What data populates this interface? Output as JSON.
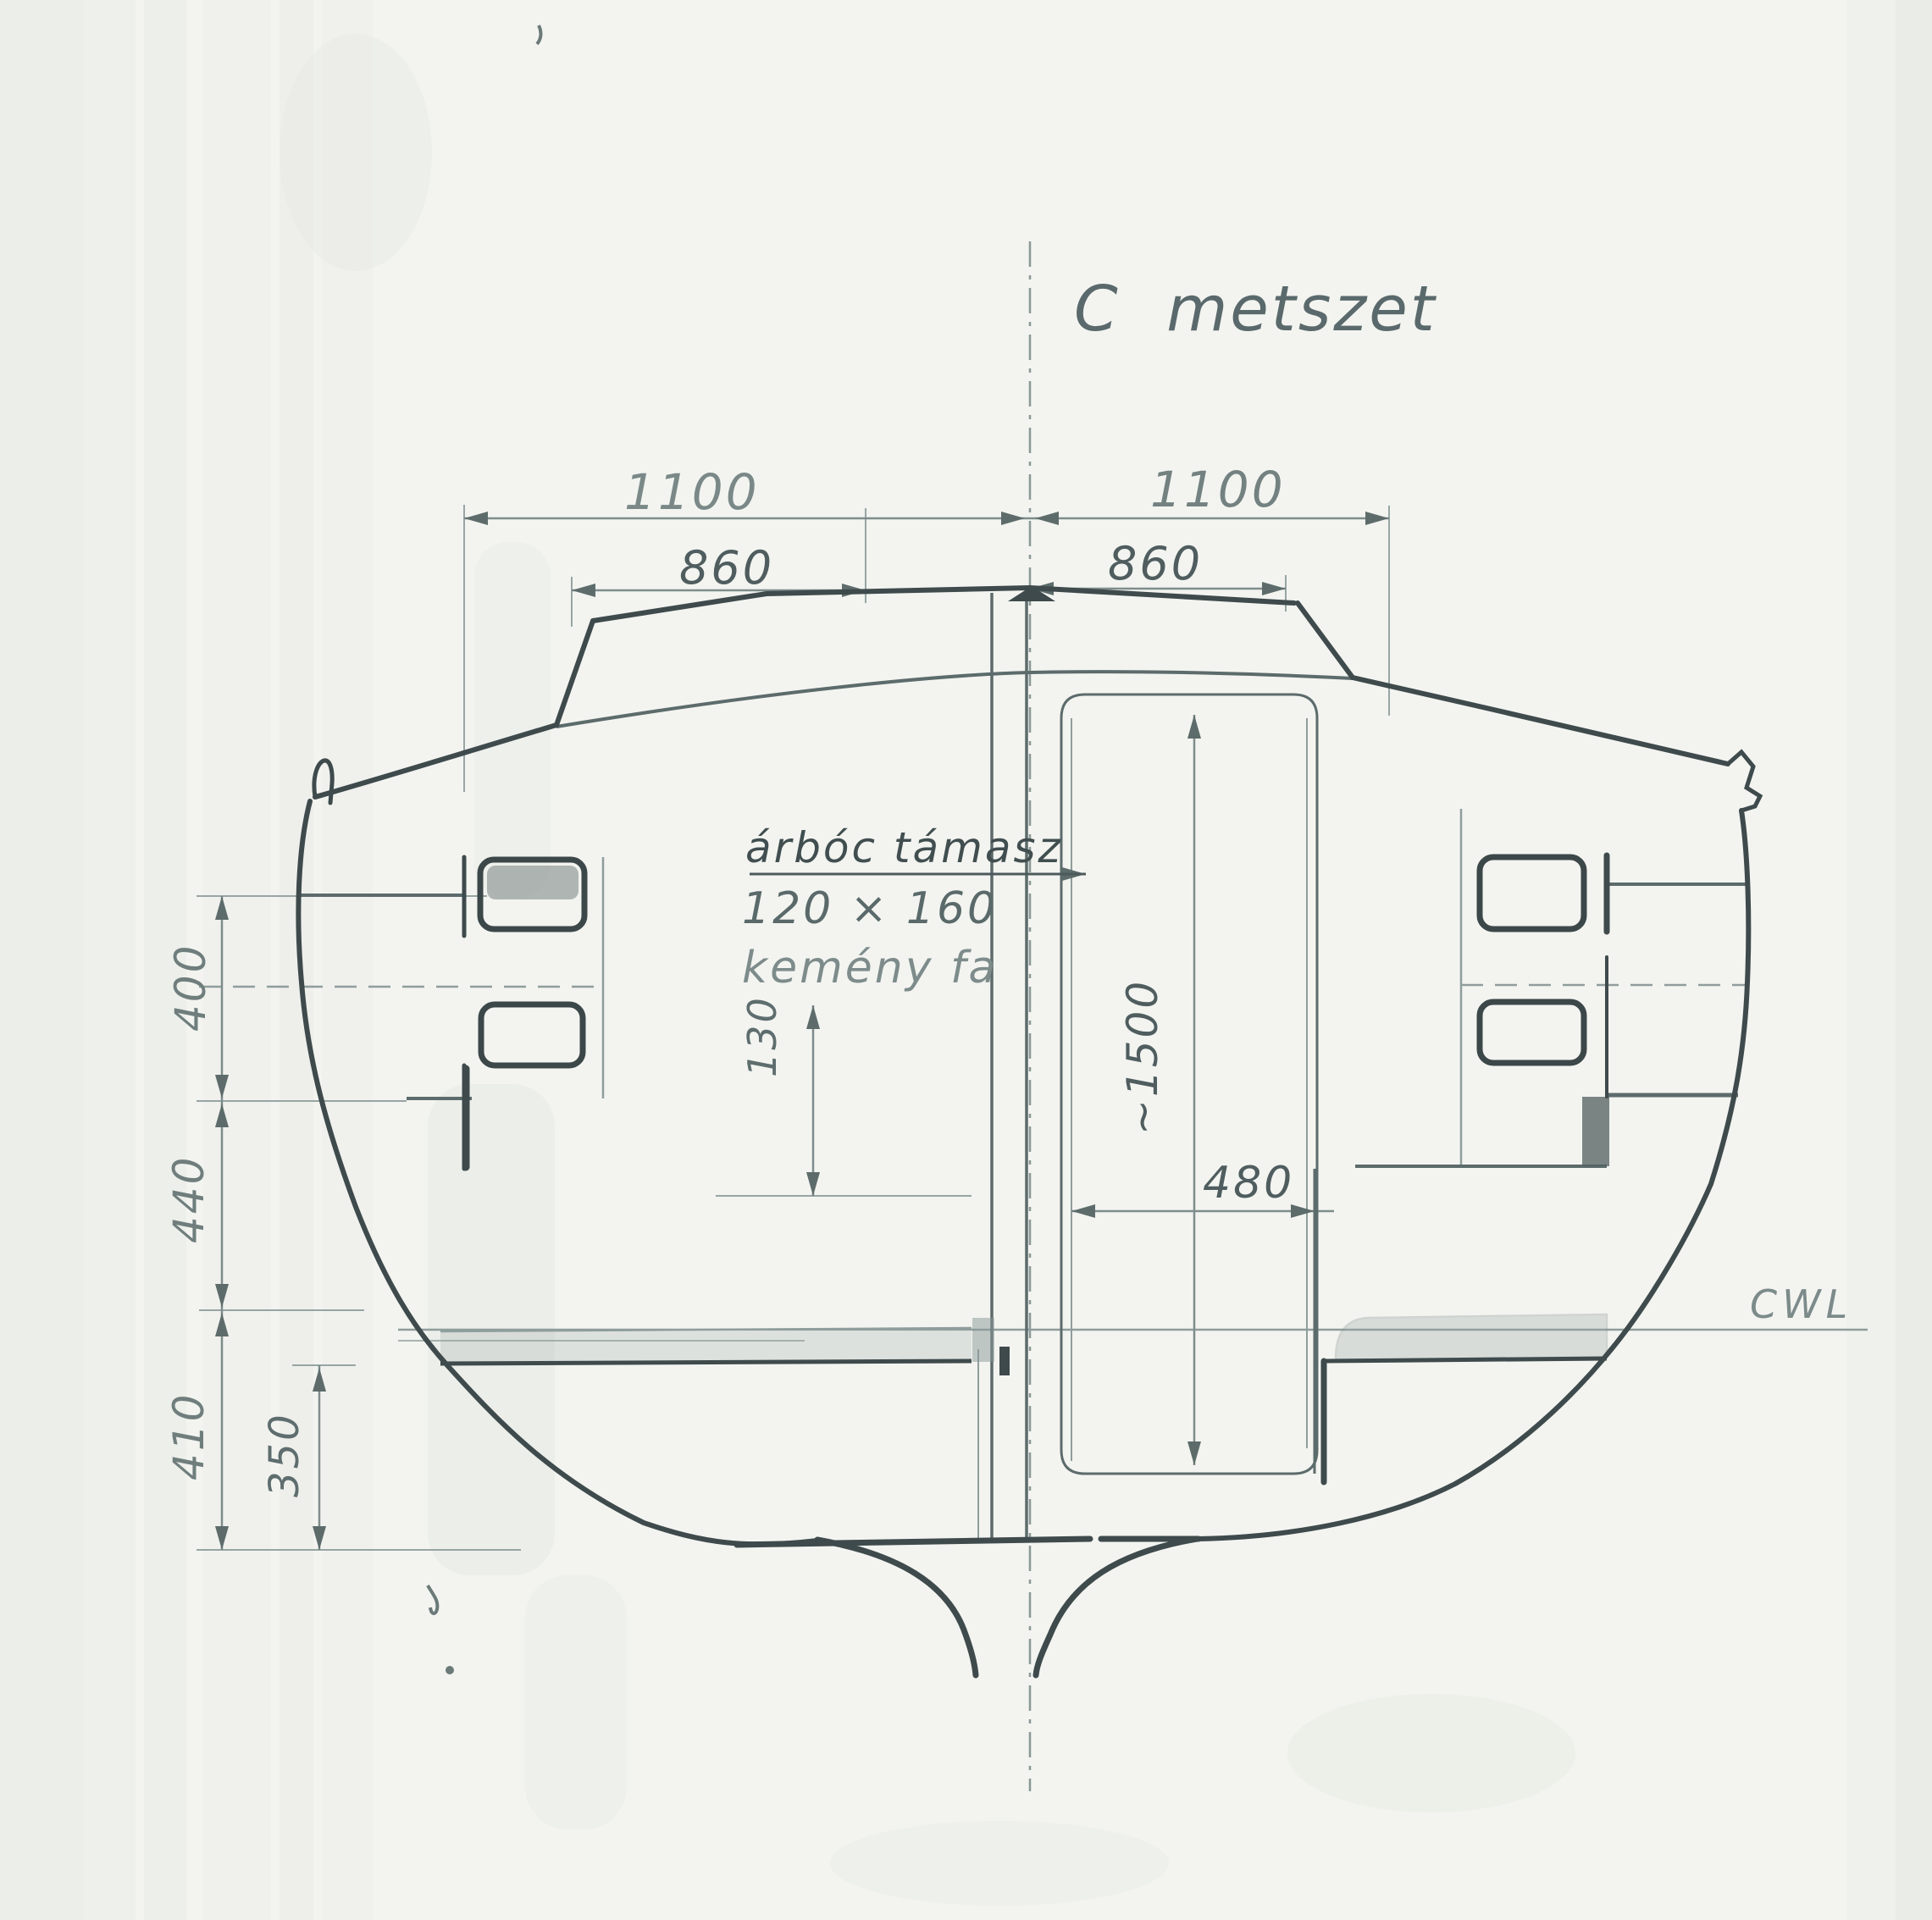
{
  "drawing": {
    "title": "C metszet",
    "waterline_label": "CWL",
    "mast_note": {
      "line1": "árbóc támasz",
      "line2": "120 × 160",
      "line3": "kemény fa"
    },
    "dims": {
      "top_left_outer": "1100",
      "top_right_outer": "1100",
      "top_left_inner": "860",
      "top_right_inner": "860",
      "left_upper": "400",
      "left_mid": "440",
      "left_lower": "410",
      "bottom_left_inner": "350",
      "mast_offset": "130",
      "case_height": "~1500",
      "case_width": "480"
    },
    "colors": {
      "paper": "#f3f4f0",
      "ink_dark": "#3e4a4c",
      "ink_medium": "#5d6c6d",
      "ink_light": "#8f9d9c",
      "label_gray": "#75847f"
    }
  }
}
